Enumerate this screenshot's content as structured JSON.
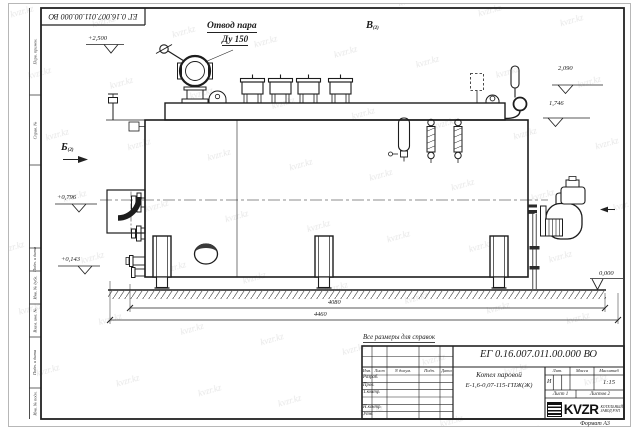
{
  "sheet": {
    "designation": "ЕГ 0.16.007.011.00.000  ВО",
    "note": "Все размеры для справок",
    "format_label": "Формат А3",
    "watermark": "kvzr.kz"
  },
  "labels": {
    "steam_outlet_line1": "Отвод пара",
    "steam_outlet_line2": "Ду 150",
    "view_top": {
      "letter": "В",
      "sheet_ref": "(2)"
    },
    "view_left": {
      "letter": "Б",
      "sheet_ref": "(2)"
    }
  },
  "elevations": [
    {
      "id": "steam-valve-top",
      "text": "+2,500"
    },
    {
      "id": "safety-valve-top",
      "text": "2,090"
    },
    {
      "id": "drum-top",
      "text": "1,746"
    },
    {
      "id": "burner-axis",
      "text": "+0,796"
    },
    {
      "id": "nozzle-axis",
      "text": "+0,143"
    },
    {
      "id": "ground-level",
      "text": "0,000"
    }
  ],
  "dimensions": {
    "length_supports": "4080",
    "length_overall": "4460"
  },
  "title_block": {
    "designation": "ЕГ 0.16.007.011.00.000  ВО",
    "product_name_line1": "Котел паровой",
    "product_name_line2": "Е-1,6-0,07-115-ГПЖ(Ж)",
    "columns": {
      "izm": "Изм.",
      "list": "Лист",
      "doc": "N докум.",
      "sign": "Подп.",
      "date": "Дата"
    },
    "rows": {
      "razrab": "Разраб.",
      "prov": "Пров.",
      "tkontr": "Т.контр.",
      "nkontr": "Н.контр.",
      "utv": "Утв."
    },
    "lit_header": "Лит.",
    "mass_header": "Масса",
    "scale_header": "Масштаб",
    "lit_value": "И",
    "scale_value": "1:15",
    "sheet_info": "Лист 1",
    "sheets_info": "Листов 2",
    "company": {
      "logo_text": "KVZR",
      "sub_line1": "КОТЕЛЬНЫЙ",
      "sub_line2": "ЗАВОД РЭП"
    }
  },
  "margin_labels": [
    "Перв. примен.",
    "Справ. №",
    "Подп. и дата",
    "Инв. № дубл.",
    "Взам. инв. №",
    "Подп. и дата",
    "Инв. № подл."
  ]
}
